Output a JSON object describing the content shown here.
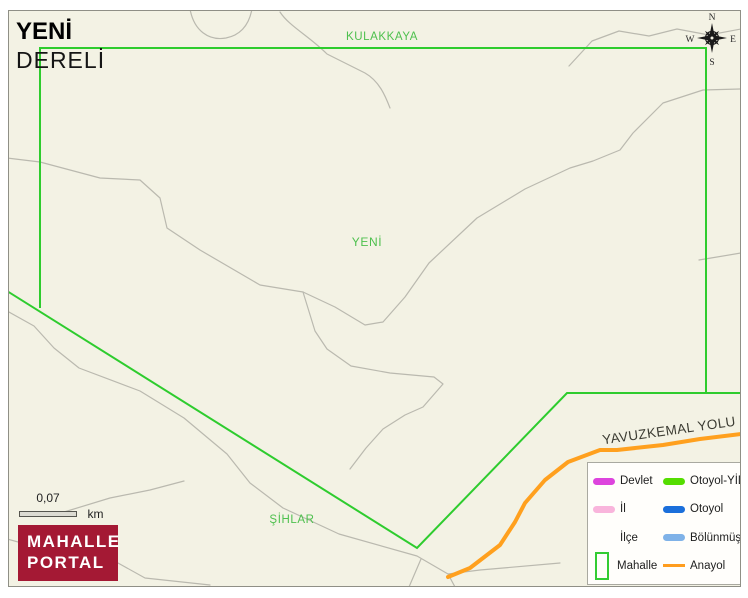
{
  "title": {
    "line1": "YENİ",
    "line2": "DERELİ"
  },
  "map_labels": {
    "top_boundary": "KULAKKAYA",
    "center": "YENİ",
    "bottom": "ŞİHLAR",
    "road": "YAVUZKEMAL YOLU"
  },
  "compass": {
    "n": "N",
    "e": "E",
    "s": "S",
    "w": "W"
  },
  "scale_bar": {
    "value": "0,07",
    "unit": "km"
  },
  "logo": {
    "line1": "MAHALLE",
    "line2": "PORTAL"
  },
  "colors": {
    "map_background": "#f3f2e4",
    "boundary_green": "#2ecc2e",
    "label_green": "#4ec04e",
    "road_gray": "#bab9af",
    "main_road_orange": "#ffa01e",
    "brand_red": "#a41934",
    "compass_black": "#1a1a1a"
  },
  "legend": {
    "items": [
      {
        "label": "Devlet",
        "color": "#dd44dd",
        "shape": "line"
      },
      {
        "label": "Otoyol-YİD",
        "color": "#55dd00",
        "shape": "line"
      },
      {
        "label": "İl",
        "color": "#f9b5dc",
        "shape": "line"
      },
      {
        "label": "Otoyol",
        "color": "#1b6fdb",
        "shape": "line"
      },
      {
        "label": "İlçe",
        "color": "transparent",
        "shape": "none"
      },
      {
        "label": "Bölünmüş Y",
        "color": "#7fb2e8",
        "shape": "line"
      },
      {
        "label": "Mahalle",
        "color": "#33cc33",
        "shape": "rect"
      },
      {
        "label": "Anayol",
        "color": "#ff9d1e",
        "shape": "thin"
      }
    ]
  }
}
